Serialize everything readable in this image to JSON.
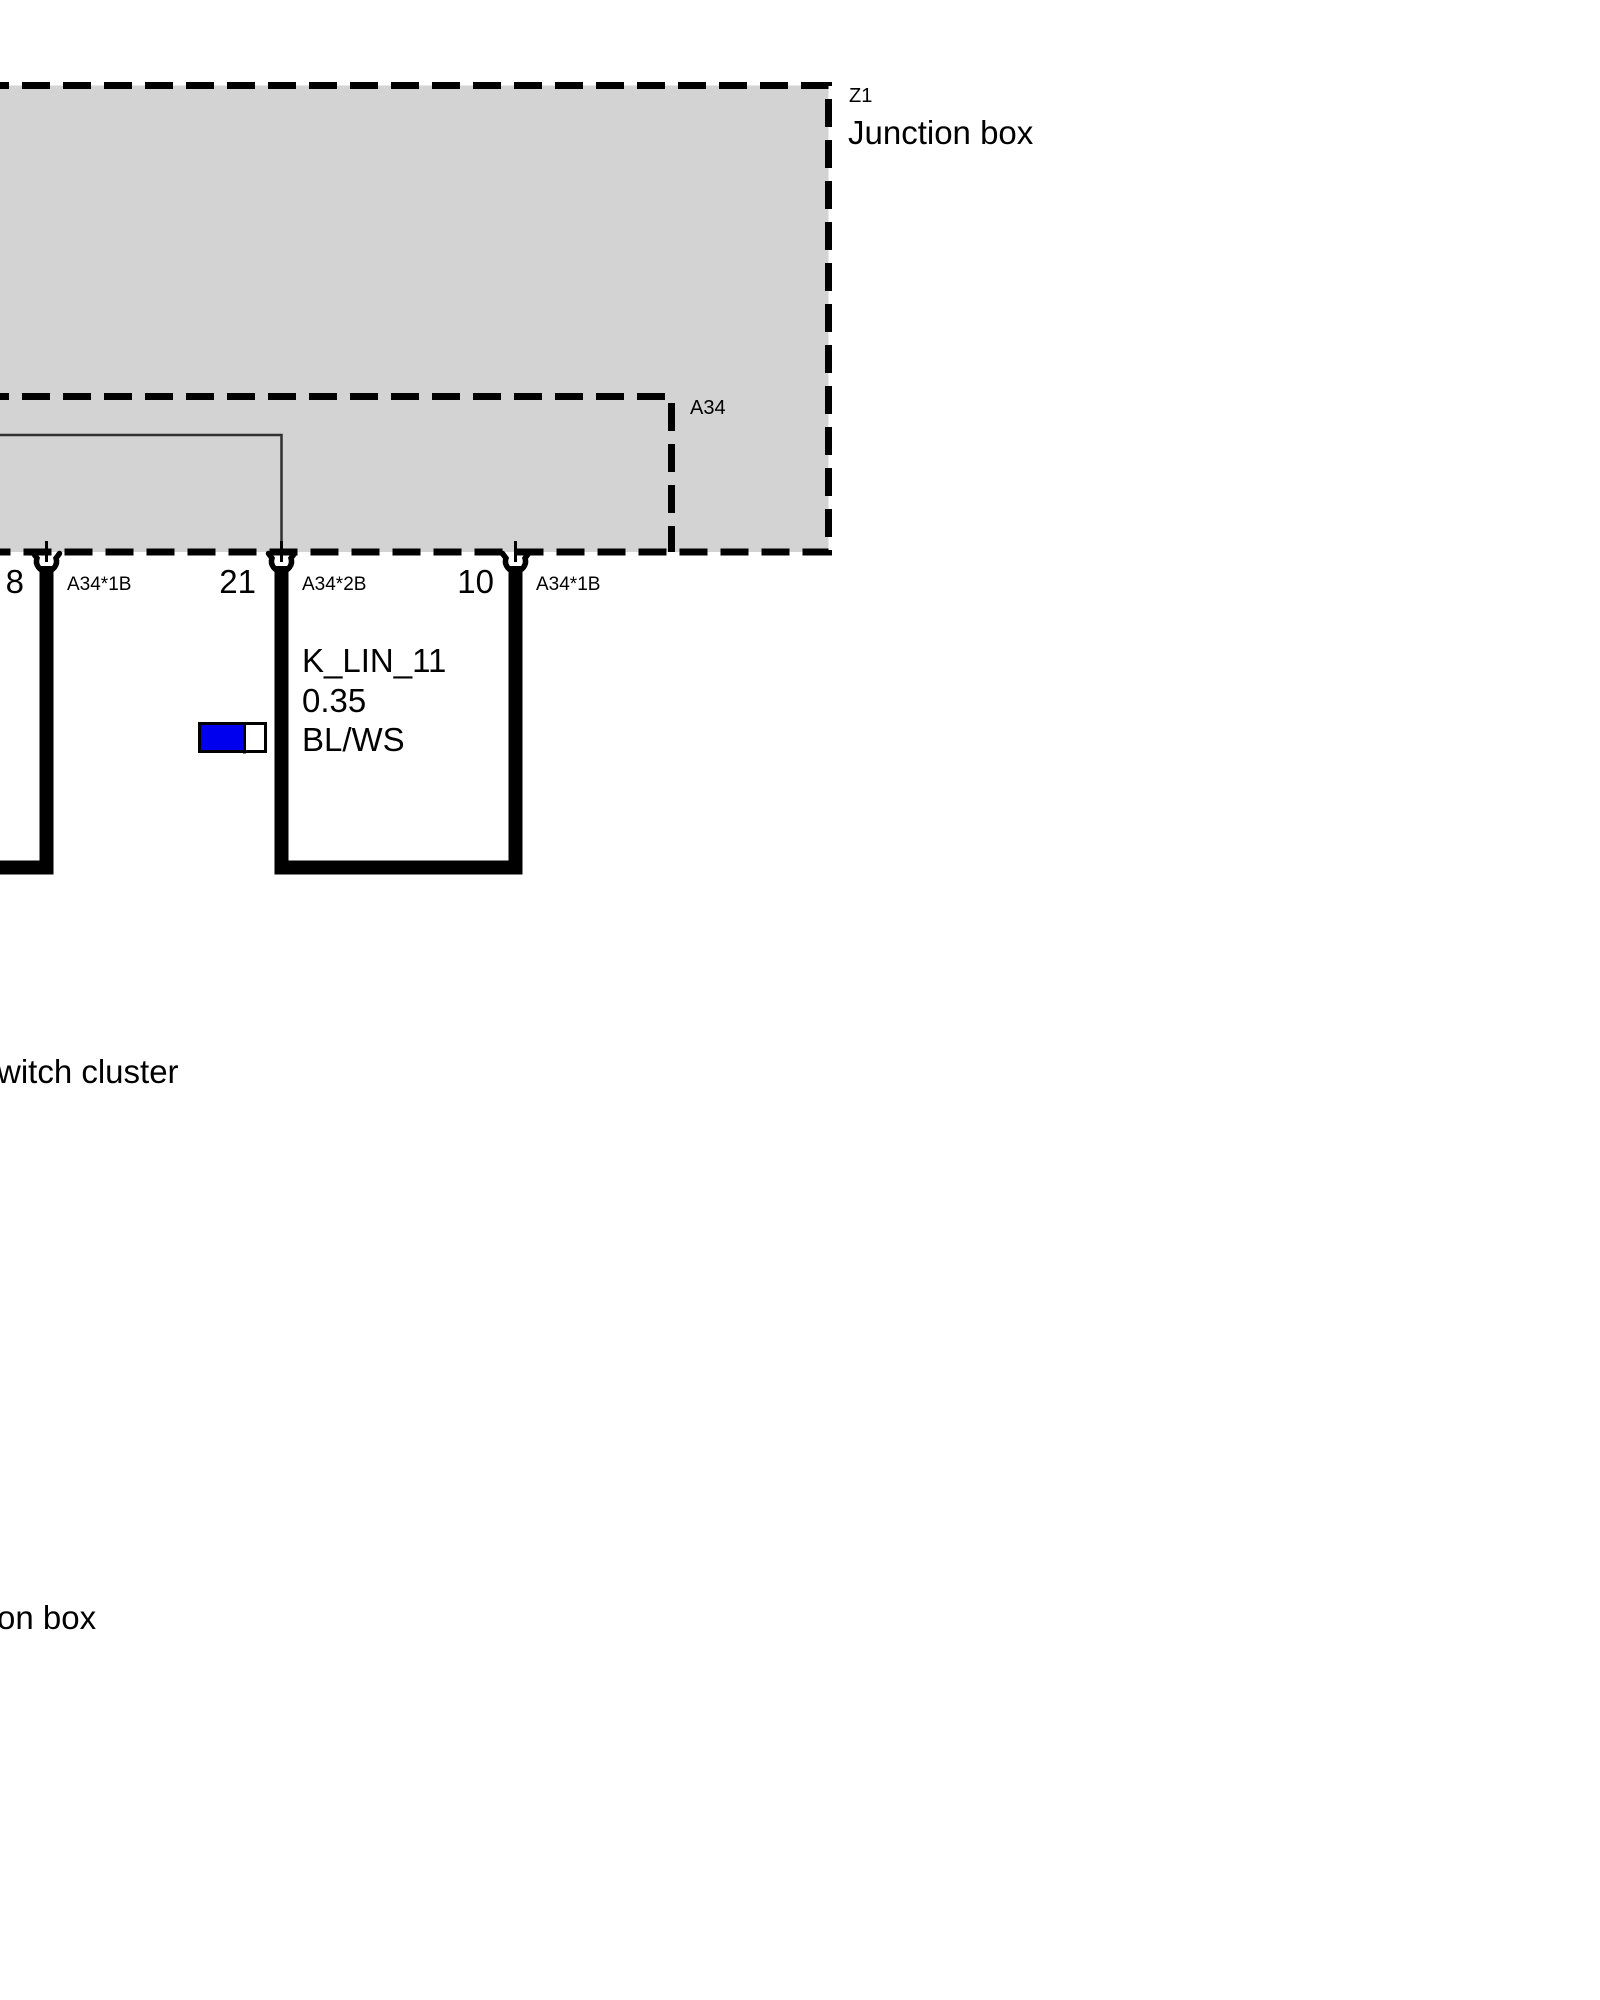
{
  "diagram": {
    "junction_box": {
      "code": "Z1",
      "label": "Junction box"
    },
    "module": {
      "code": "A34"
    },
    "connectors": [
      {
        "pin": "8",
        "connector": "A34*1B"
      },
      {
        "pin": "21",
        "connector": "A34*2B"
      },
      {
        "pin": "10",
        "connector": "A34*1B"
      }
    ],
    "wire": {
      "signal": "K_LIN_11",
      "cross_section": "0.35",
      "color_code": "BL/WS"
    },
    "partial_labels": {
      "left_component": "witch cluster",
      "bottom_component": "on box"
    },
    "colors": {
      "component_fill": "#d3d3d3",
      "wire_chip_blue": "#0000ee",
      "wire_chip_white": "#ffffff",
      "line": "#000000"
    }
  }
}
